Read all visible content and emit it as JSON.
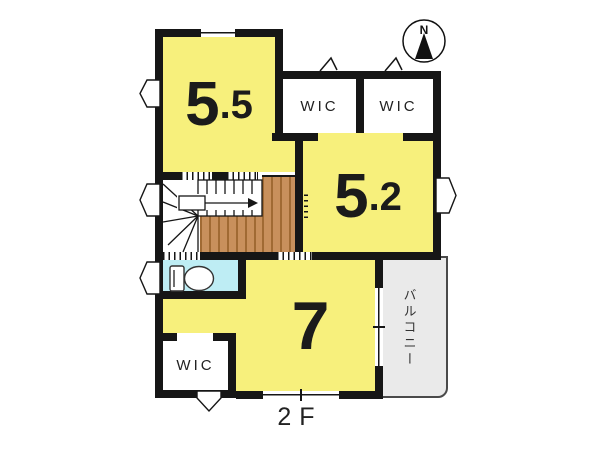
{
  "floor": {
    "label": "2F"
  },
  "compass": {
    "north_label": "N"
  },
  "rooms": {
    "bedroom_a": {
      "area_whole": "5",
      "area_frac": ".5"
    },
    "bedroom_b": {
      "area_whole": "5",
      "area_frac": ".2"
    },
    "bedroom_c": {
      "area_whole": "7",
      "area_frac": ""
    },
    "wic_top_left": {
      "label": "WIC"
    },
    "wic_top_right": {
      "label": "WIC"
    },
    "wic_bottom": {
      "label": "WIC"
    },
    "balcony": {
      "label": "バルコニー"
    }
  },
  "colors": {
    "room_fill": "#F7F07C",
    "toilet_fill": "#BEEDF4",
    "wood_fill": "#C8905C",
    "balcony_fill": "#EAEAEA",
    "wall": "#161616"
  }
}
